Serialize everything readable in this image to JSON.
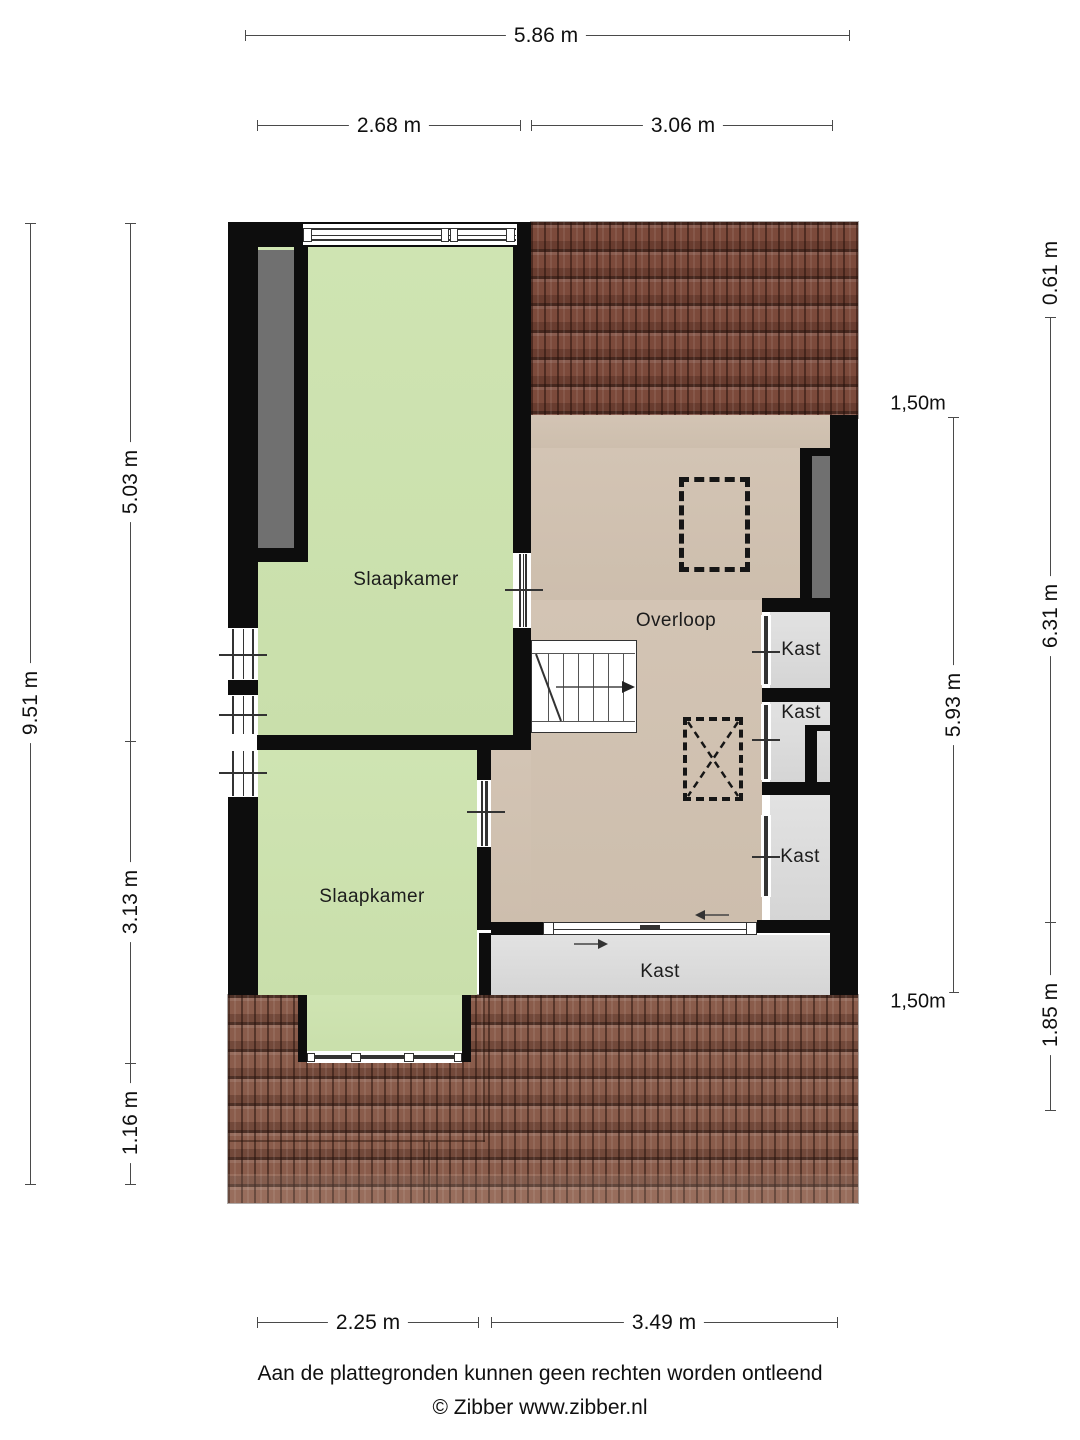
{
  "plan": {
    "type": "floor-plan",
    "floor": "verdieping",
    "rooms": {
      "bedroom_top": "Slaapkamer",
      "bedroom_bottom": "Slaapkamer",
      "landing": "Overloop",
      "closet_1": "Kast",
      "closet_2": "Kast",
      "closet_3": "Kast",
      "closet_bottom": "Kast"
    }
  },
  "dimensions": {
    "top_total": "5.86 m",
    "top_left": "2.68 m",
    "top_right": "3.06 m",
    "left_total": "9.51 m",
    "left_upper": "5.03 m",
    "left_middle": "3.13 m",
    "left_lower": "1.16 m",
    "right_upper": "0.61 m",
    "right_middle": "6.31 m",
    "right_lower": "1.85 m",
    "inner_height_top": "1,50m",
    "inner_span": "5.93 m",
    "inner_height_bottom": "1,50m",
    "bottom_left": "2.25 m",
    "bottom_right": "3.49 m"
  },
  "footer": {
    "disclaimer": "Aan de plattegronden kunnen geen rechten worden ontleend",
    "credit": "© Zibber www.zibber.nl"
  },
  "colors": {
    "wall": "#0d0d0d",
    "bedroom_fill": "#cce1ad",
    "landing_fill": "#d0c1b1",
    "closet_fill": "#dedede",
    "low_ceiling_fill": "#707070",
    "roof_upper": "#7c4a3b",
    "roof_lower": "#8a5c4b"
  }
}
